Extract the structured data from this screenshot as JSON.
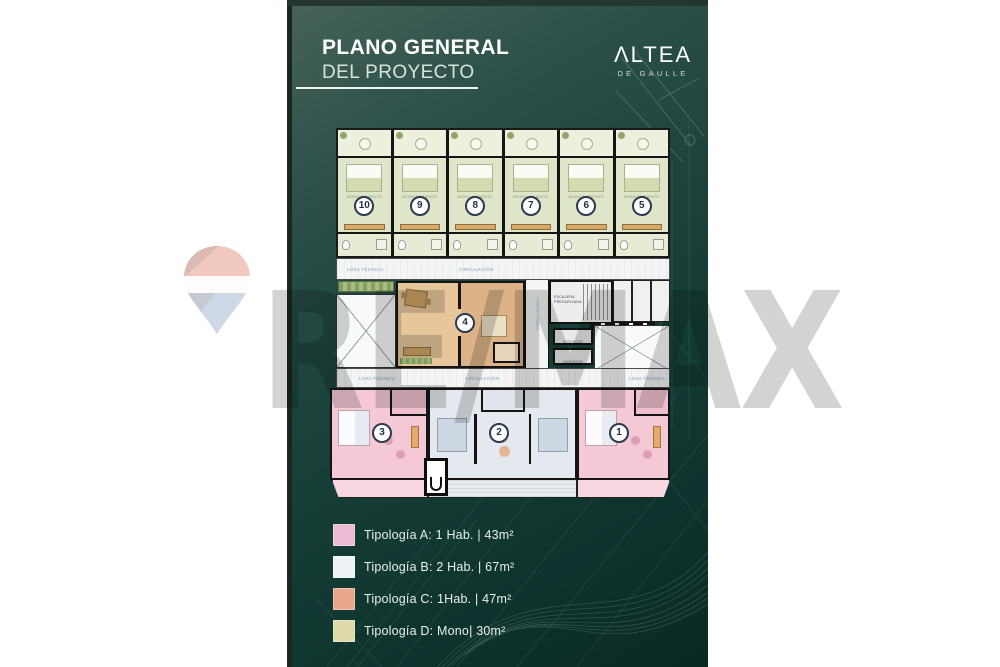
{
  "page": {
    "background": "#ffffff",
    "panel_color": "#16423c"
  },
  "header": {
    "title_line1": "PLANO GENERAL",
    "title_line2": "DEL PROYECTO"
  },
  "brand": {
    "wordmark": "ΛLTEA",
    "subtitle": "DE GAULLE"
  },
  "watermark": {
    "text": "RE/MAX"
  },
  "floor_plan": {
    "room_label": "MONOAMBIENTE",
    "corridor_label": "CIRCULACIÓN",
    "technical_slab_label": "LOSA TÉCNICA",
    "stairs_label": "ESCALERA PRESURIZADA",
    "elevator_label": "ASCENSOR",
    "top_units": [
      {
        "number": "10"
      },
      {
        "number": "9"
      },
      {
        "number": "8"
      },
      {
        "number": "7"
      },
      {
        "number": "6"
      },
      {
        "number": "5"
      }
    ],
    "middle_unit": {
      "number": "4"
    },
    "bottom_units": [
      {
        "number": "3"
      },
      {
        "number": "2"
      },
      {
        "number": "1"
      }
    ]
  },
  "legend": {
    "items": [
      {
        "label": "Tipología A: 1 Hab. | 43m²",
        "color": "#ecbcd4"
      },
      {
        "label": "Tipología B: 2 Hab. | 67m²",
        "color": "#eef2f4"
      },
      {
        "label": "Tipología C: 1Hab. | 47m²",
        "color": "#e9a88b"
      },
      {
        "label": "Tipología D: Mono| 30m²",
        "color": "#ddd9a8"
      }
    ]
  }
}
